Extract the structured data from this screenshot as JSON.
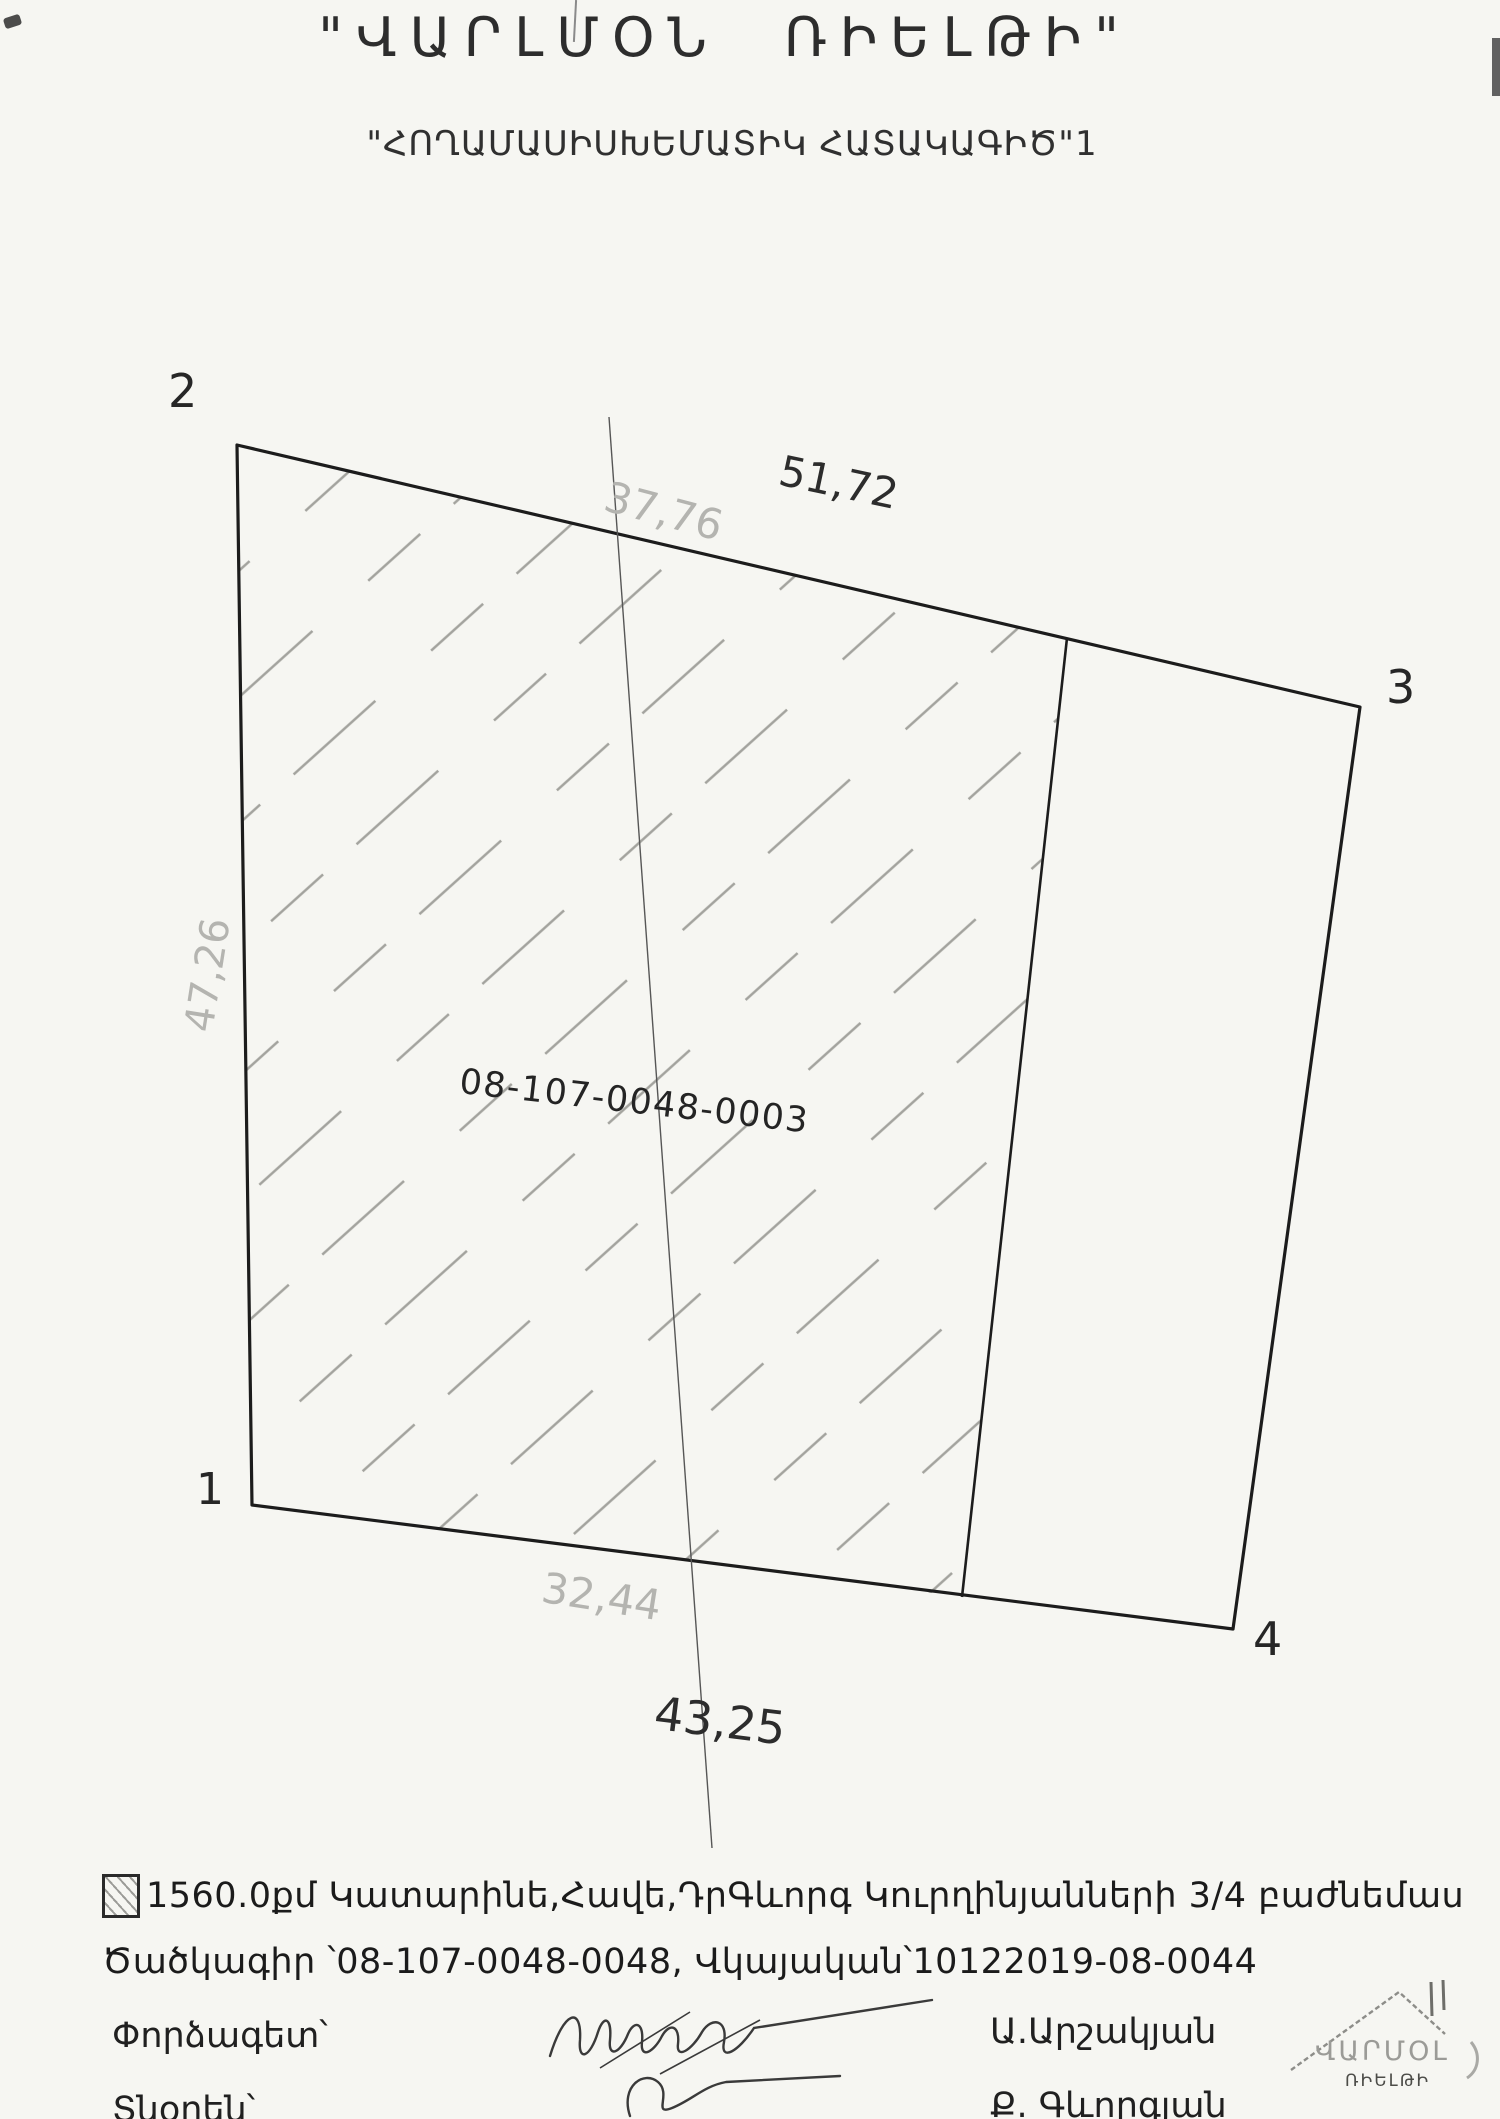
{
  "header": {
    "title": "\"ՎԱՐԼՄՕՆ ՌԻԵԼԹԻ\"",
    "subtitle": "\"ՀՈՂԱՄԱՍԻՍԽԵՄԱՏԻԿ ՀԱՏԱԿԱԳԻԾ\"1"
  },
  "diagram": {
    "parcel_code": "08-107-0048-0003",
    "corners": {
      "c1": "1",
      "c2": "2",
      "c3": "3",
      "c4": "4"
    },
    "dims": {
      "top_outer": "51,72",
      "top_inner_faded": "37,76",
      "left_faded": "47,26",
      "bottom_inner_faded": "32,44",
      "bottom_outer": "43,25"
    }
  },
  "legend": {
    "area_line": "1560.0քմ Կատարինե,Հավե,ԴրԳևորգ Կուրղինյանների 3/4 բաժնեմաս",
    "code_line": "Ծածկագիր ՝08-107-0048-0048, Վկայական՝10122019-08-0044"
  },
  "signers": {
    "expert_label": "Փորձագետ՝",
    "expert_name": "Ա.Արշակյան",
    "director_label": "Տնօրեն՝",
    "director_name": "Ք. Գևորգյան"
  },
  "logo": {
    "name_top": "ՎԱՐՄՕԼ",
    "name_bottom": "ՌԻԵԼԹԻ"
  }
}
